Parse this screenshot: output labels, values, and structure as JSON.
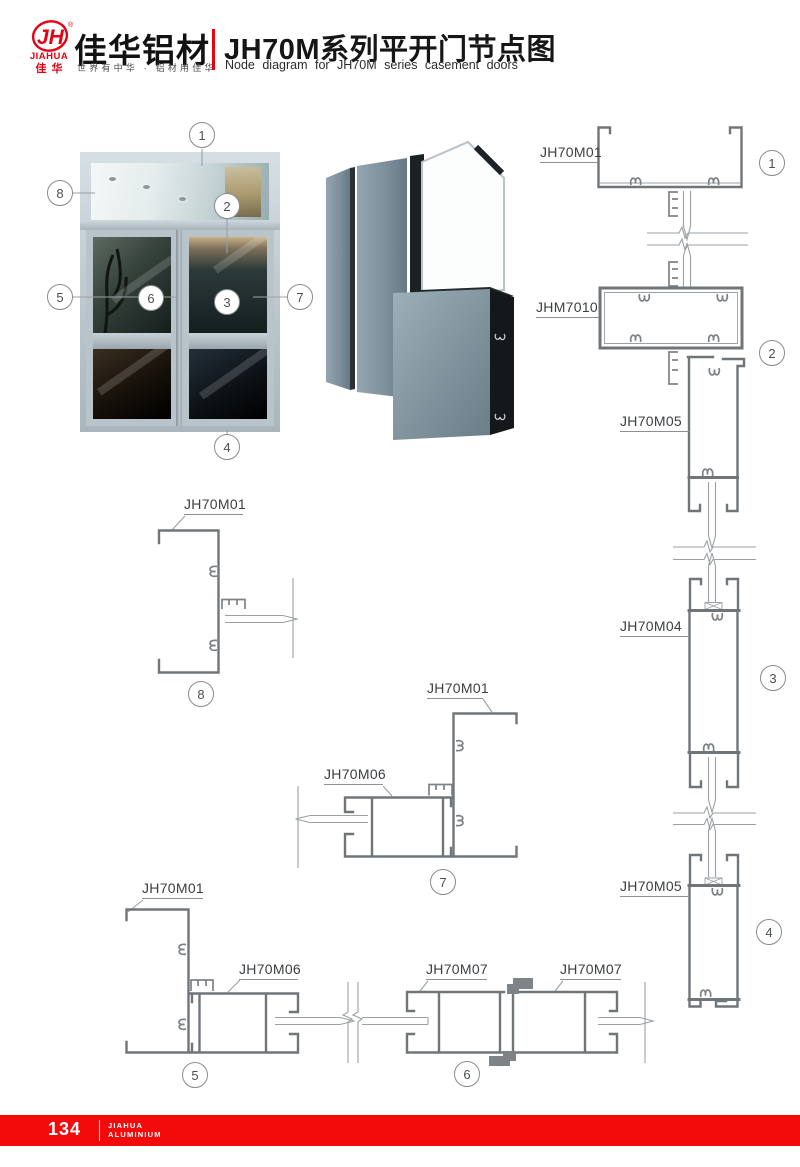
{
  "header": {
    "logo": {
      "monogram": "JH",
      "registered": "®",
      "brand_en": "JIAHUA",
      "brand_cn": "佳华"
    },
    "company_name": "佳华铝材",
    "slogan": "世界有中华 · 铝材用佳华",
    "title_cn": "JH70M系列平开门节点图",
    "title_en": "Node diagram for JH70M series casement doors"
  },
  "photo": {
    "callouts": [
      "1",
      "2",
      "3",
      "4",
      "5",
      "6",
      "7",
      "8"
    ]
  },
  "diagrams": {
    "top_head": {
      "profile": "JH70M01",
      "callout": "1"
    },
    "transom_mid": {
      "profile": "JHM7010",
      "callout": "2"
    },
    "transom_jamb": {
      "profile": "JH70M05"
    },
    "door_mid_rail": {
      "profile": "JH70M04",
      "callout": "3"
    },
    "sill": {
      "profile": "JH70M05",
      "callout": "4"
    },
    "head_section": {
      "profile": "JH70M01",
      "callout": "8"
    },
    "hinge_jamb": {
      "frame": "JH70M01",
      "stile": "JH70M06",
      "callout": "7"
    },
    "lock_jamb": {
      "frame": "JH70M01",
      "stile": "JH70M06",
      "callout": "5"
    },
    "meeting_stiles": {
      "left": "JH70M07",
      "right": "JH70M07",
      "callout": "6"
    }
  },
  "footer": {
    "page_number": "134",
    "brand_line1": "JIAHUA",
    "brand_line2": "ALUMINIUM"
  },
  "colors": {
    "accent_red": "#e60012",
    "footer_red": "#f30b0b",
    "line_gray": "#70757a"
  }
}
